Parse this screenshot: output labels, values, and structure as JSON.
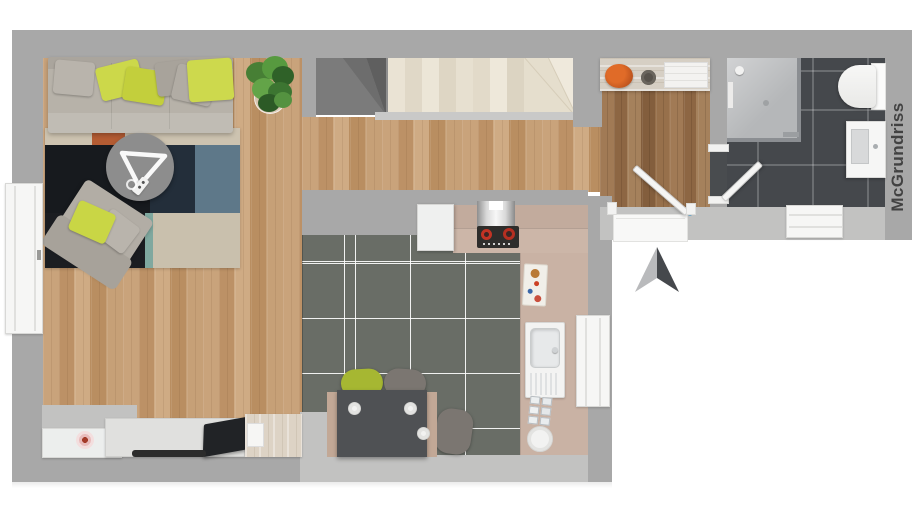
{
  "watermark": {
    "text": "McGrundriss"
  },
  "plan": {
    "type": "3d-floor-plan-top-view",
    "north_arrow": "present",
    "rooms": [
      {
        "name": "living-room",
        "floor": "light-oak-plank",
        "items": [
          "corner-sofa",
          "decor-pillows",
          "potted-plant",
          "patchwork-rug",
          "round-coffee-table",
          "armchair",
          "sideboard-with-flower",
          "tv-board",
          "flat-tv",
          "soundbar",
          "whitewash-cabinet",
          "tall-window"
        ]
      },
      {
        "name": "open-kitchen",
        "floor": "dark-gray-tiles",
        "items": [
          "tall-white-cabinet",
          "extractor-hood",
          "cooktop-with-red-burners",
          "l-shaped-counter",
          "cutting-board",
          "sink-with-drainer",
          "spice-set",
          "round-plate",
          "dining-table-with-plates",
          "three-chairs",
          "window"
        ]
      },
      {
        "name": "staircase",
        "items": [
          "winder-stairs"
        ]
      },
      {
        "name": "hallway",
        "floor": "dark-oak-plank",
        "items": [
          "sideboard",
          "orange-bowl",
          "dark-bowl",
          "white-tray",
          "entrance-door",
          "door-step"
        ]
      },
      {
        "name": "bathroom",
        "floor": "anthracite-tiles",
        "items": [
          "corner-shower",
          "toilet",
          "washbasin-cabinet",
          "window",
          "interior-door"
        ]
      }
    ]
  },
  "colors": {
    "wall": "#a8a8a8",
    "wall_light": "#c2c2c1",
    "wood_light": "#c49d75",
    "wood_dark": "#9b7450",
    "kitchen_tile": "#696d66",
    "bath_tile": "#45484c",
    "counter": "#c9b2a4",
    "pillow_green": "#ccd84a",
    "chair_green": "#a6b732",
    "rug_navy": "#232e3a",
    "rug_blue": "#5e7889",
    "orange_decor": "#c2571f",
    "cooktop_red": "#c23324",
    "watermark_text": "#424242"
  }
}
